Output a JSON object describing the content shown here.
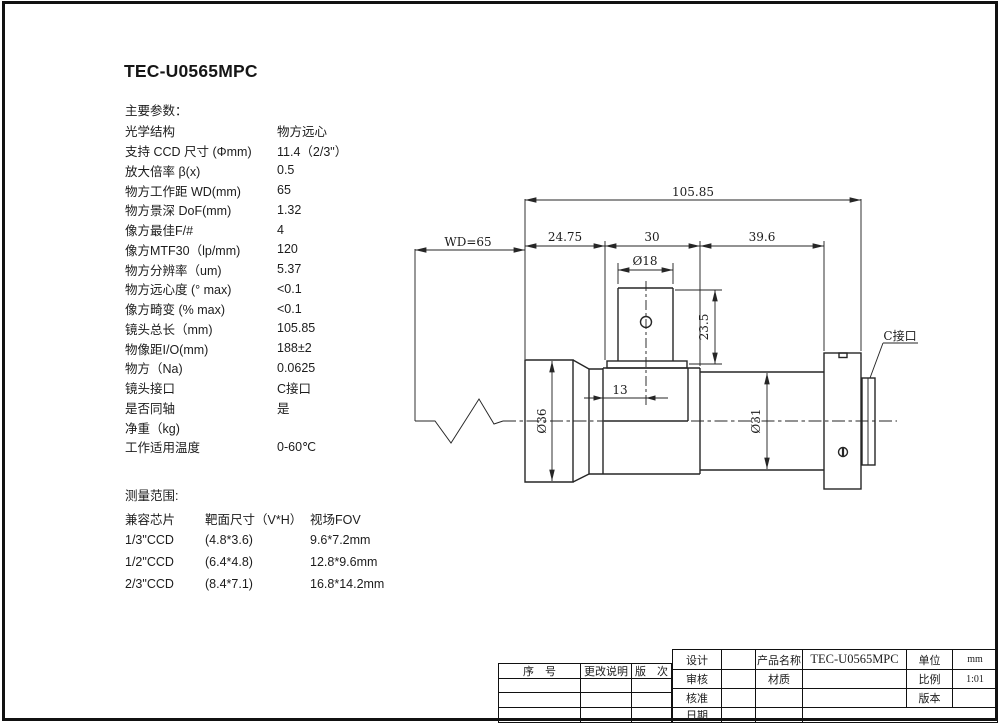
{
  "page": {
    "title": "TEC-U0565MPC"
  },
  "params": {
    "heading": "主要参数：",
    "rows": [
      {
        "label": "光学结构",
        "value": "物方远心"
      },
      {
        "label": "支持 CCD 尺寸 (Φmm)",
        "value": "11.4（2/3\"）"
      },
      {
        "label": "放大倍率 β(x)",
        "value": "0.5"
      },
      {
        "label": "物方工作距 WD(mm)",
        "value": "65"
      },
      {
        "label": "物方景深 DoF(mm)",
        "value": "1.32"
      },
      {
        "label": "像方最佳F/#",
        "value": "4"
      },
      {
        "label": "像方MTF30（lp/mm)",
        "value": "120"
      },
      {
        "label": "物方分辨率（um)",
        "value": "5.37"
      },
      {
        "label": "物方远心度 (° max)",
        "value": "<0.1"
      },
      {
        "label": "像方畸变 (% max)",
        "value": "<0.1"
      },
      {
        "label": "镜头总长（mm)",
        "value": "105.85"
      },
      {
        "label": "物像距I/O(mm)",
        "value": "188±2"
      },
      {
        "label": "物方（Na)",
        "value": "0.0625"
      },
      {
        "label": "镜头接口",
        "value": "C接口"
      },
      {
        "label": "是否同轴",
        "value": "是"
      },
      {
        "label": "净重（kg)",
        "value": ""
      },
      {
        "label": "工作适用温度",
        "value": "0-60℃"
      }
    ]
  },
  "measurement": {
    "heading": "测量范围:",
    "headers": [
      "兼容芯片",
      "靶面尺寸（V*H）",
      "视场FOV"
    ],
    "rows": [
      [
        "1/3\"CCD",
        "(4.8*3.6)",
        "9.6*7.2mm"
      ],
      [
        "1/2\"CCD",
        "(6.4*4.8)",
        "12.8*9.6mm"
      ],
      [
        "2/3\"CCD",
        "(8.4*7.1)",
        "16.8*14.2mm"
      ]
    ]
  },
  "drawing": {
    "dims": {
      "total_length": "105.85",
      "working_distance": "WD=65",
      "front_length": "24.75",
      "mid_length": "30",
      "rear_length": "39.6",
      "port_diameter": "Ø18",
      "port_height": "23.5",
      "port_offset": "13",
      "front_diameter": "Ø36",
      "rear_diameter": "Ø31",
      "mount_label": "C接口"
    }
  },
  "titleblock": {
    "revision": {
      "headers": [
        "序　号",
        "更改说明",
        "版　次"
      ]
    },
    "info": {
      "design": "设计",
      "product_name_label": "产品名称",
      "product_name": "TEC-U0565MPC",
      "unit_label": "单位",
      "unit": "mm",
      "review": "审核",
      "material_label": "材质",
      "scale_label": "比例",
      "scale": "1:01",
      "approve": "核准",
      "version_label": "版本",
      "date": "日期"
    }
  }
}
